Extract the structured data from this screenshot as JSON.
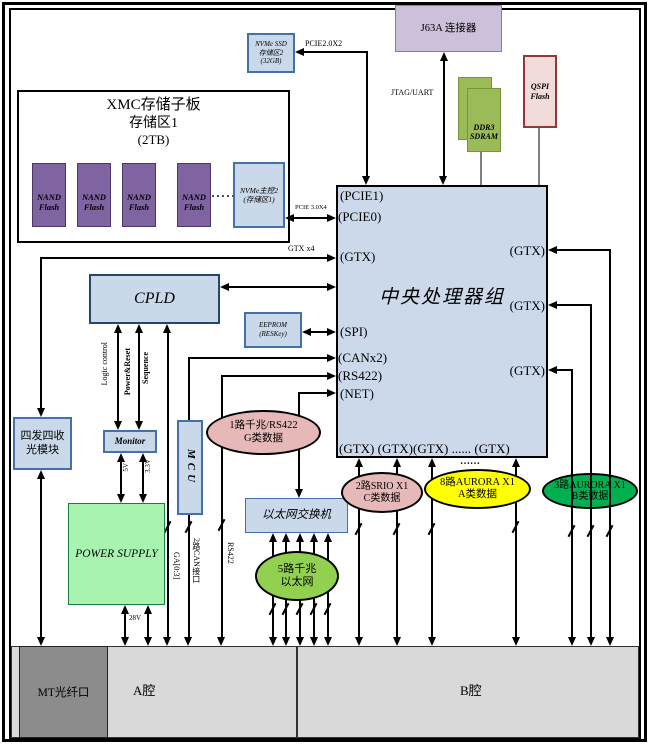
{
  "diagram": {
    "nvme_ssd": [
      "NVMe SSD",
      "存储区2",
      "(32GB)"
    ],
    "pcie20_label": "PCIE2.0X2",
    "xmc_board": {
      "title": "XMC存储子板",
      "subtitle": "存储区1",
      "capacity": "(2TB)",
      "nand": [
        "NAND",
        "Flash"
      ],
      "dots": "·····",
      "master": [
        "NVMe主控2",
        "(存储区1)"
      ]
    },
    "pcie30_label": "PCIE 3.0X4",
    "j63a": "J63A 连接器",
    "jtag_label": "JTAG/UART",
    "ddr3": [
      "DDR3",
      "SDRAM"
    ],
    "qspi": [
      "QSPI",
      "Flash"
    ],
    "cpu": {
      "title": "中央处理器组",
      "left_ports": [
        "(PCIE1)",
        "(PCIE0)",
        "(GTX)",
        "(SPI)",
        "(CANx2)",
        "(RS422)",
        "(NET)"
      ],
      "right_ports": [
        "(GTX)",
        "(GTX)",
        "(GTX)"
      ],
      "bottom_ports": "(GTX) (GTX)(GTX) ...... (GTX)"
    },
    "gtx4_label": "GTX x4",
    "cpld": "CPLD",
    "eeprom": [
      "EEPROM",
      "(RESKey)"
    ],
    "logic_label": "Logic control",
    "power_reset_label": [
      "Power&Reset",
      "Sequence"
    ],
    "monitor": "Monitor",
    "mcu": "MCU",
    "optical": [
      "四发四收",
      "光模块"
    ],
    "power_supply": "POWER SUPPLY",
    "rail_5v": "5V",
    "rail_33v": "3.3V",
    "rail_28v": "28V",
    "ga_label": "GA[0:3]",
    "can_label": "2路CAN接口",
    "rs422_label": "RS422",
    "eth_switch": "以太网交换机",
    "eth5": [
      "5路千兆",
      "以太网"
    ],
    "g_data": [
      "1路千兆/RS422",
      "G类数据"
    ],
    "srio": [
      "2路SRIO X1",
      "C类数据"
    ],
    "aurora_a": [
      "8路AURORA X1",
      "A类数据"
    ],
    "aurora_b": [
      "3路AURORA X1",
      "B类数据"
    ],
    "dots_more": "……",
    "bay": {
      "mt": "MT光纤口",
      "a": "A腔",
      "b": "B腔"
    }
  },
  "colors": {
    "box_fill": "#C9D9EA",
    "box_border": "#4472A8",
    "nand_purple": "#8064A2",
    "j63a_lavender": "#CCC0DA",
    "ddr3_green": "#9BBB59",
    "qspi_pink": "#F2DCDB",
    "qspi_border": "#953735",
    "power_green": "#A8F3B0",
    "ellipse_pink": "#E6B9B8",
    "ellipse_yellow": "#FFFF00",
    "ellipse_green": "#00B050",
    "eth5_green": "#92D050",
    "bay_gray": "#D9D9D9",
    "mt_gray": "#8C8C8C"
  }
}
